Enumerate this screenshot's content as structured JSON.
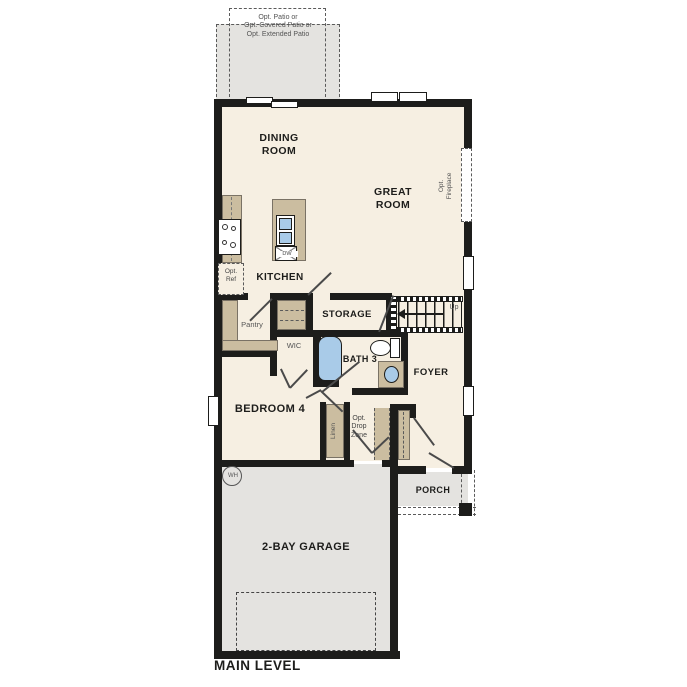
{
  "title": "MAIN LEVEL",
  "patio": {
    "line1": "Opt. Patio or",
    "line2": "Opt. Covered Patio or",
    "line3": "Opt. Extended Patio"
  },
  "rooms": {
    "dining": "DINING ROOM",
    "great": "GREAT ROOM",
    "kitchen": "KITCHEN",
    "storage": "STORAGE",
    "bath3": "BATH 3",
    "foyer": "FOYER",
    "bedroom4": "BEDROOM 4",
    "porch": "PORCH",
    "garage": "2-BAY GARAGE"
  },
  "features": {
    "pantry": "Pantry",
    "wic": "WIC",
    "linen": "Linen",
    "drop_zone": "Opt. Drop Zone",
    "opt_ref": "Opt. Ref",
    "opt_fireplace": "Opt. Fireplace",
    "up": "Up",
    "water_heater": "WH",
    "dishwasher": "DW"
  },
  "colors": {
    "wall": "#1d1d1b",
    "floor": "#f6efe2",
    "garage_floor": "#e4e3e0",
    "patio": "#e4e3e0",
    "cabinet": "#cbbda0",
    "fixture_blue": "#a9cbe8"
  }
}
